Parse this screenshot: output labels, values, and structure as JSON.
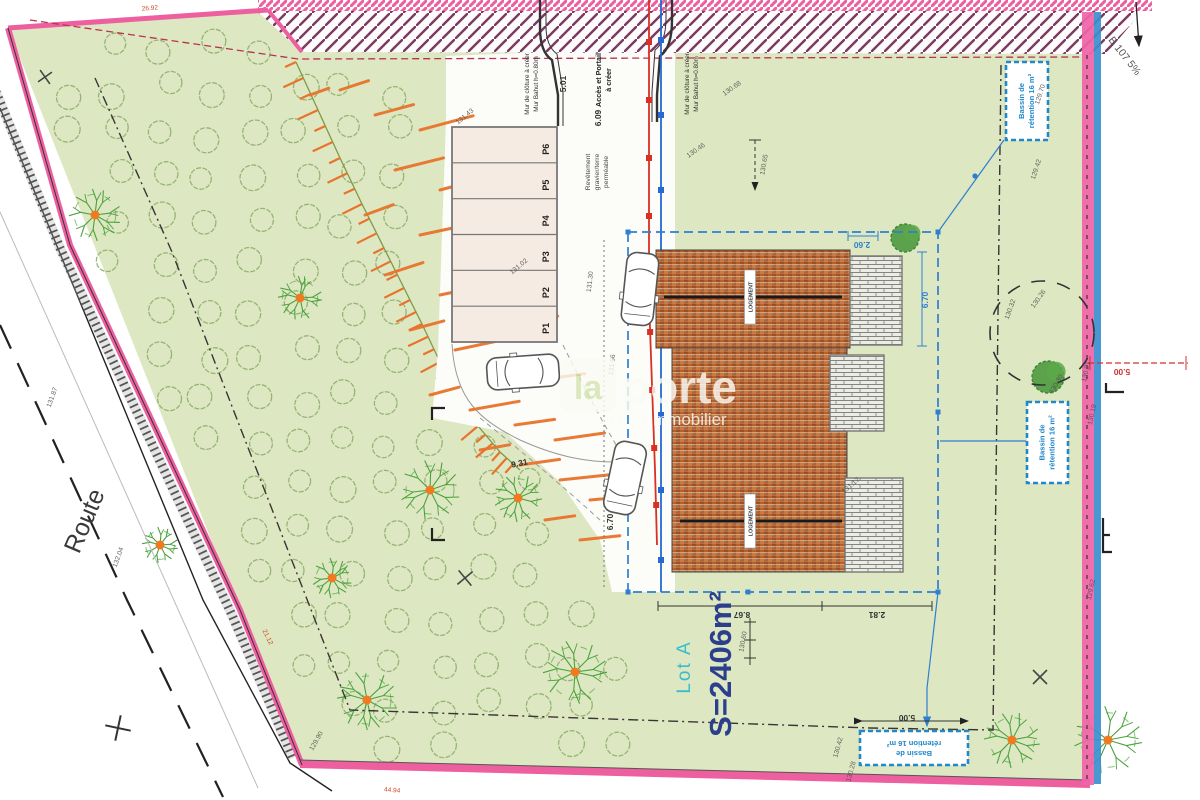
{
  "watermark": {
    "logo_text": "la",
    "brand": "porte",
    "tagline": "le sens de l'immobilier"
  },
  "site": {
    "road_label": "Route",
    "lot_label": "Lot A",
    "lot_area": "S=2406m²",
    "adjacent_label": "B 107 5%",
    "access_line1": "Accès et Portail",
    "access_line2": "à créer",
    "wall_label_line1": "Mur de clôture à créer",
    "wall_label_line2": "Mur Bahut h=0.80m",
    "surface_label": [
      "Revêtement",
      "gravier/terre",
      "perméable"
    ],
    "basin_line1": "Bassin de",
    "basin_line2": "rétention 16 m²",
    "ridge_label": "LOGEMENT"
  },
  "parking": {
    "spaces": [
      "P1",
      "P2",
      "P3",
      "P4",
      "P5",
      "P6"
    ]
  },
  "dimensions": [
    {
      "t": "5.01",
      "x": 566,
      "y": 84,
      "r": -90,
      "c": "dark"
    },
    {
      "t": "6.09",
      "x": 601,
      "y": 118,
      "r": -90,
      "c": "dark"
    },
    {
      "t": "2.60",
      "x": 862,
      "y": 242,
      "r": 180,
      "c": "blue"
    },
    {
      "t": "6.70",
      "x": 928,
      "y": 300,
      "r": -90,
      "c": "blue"
    },
    {
      "t": "6.70",
      "x": 613,
      "y": 522,
      "r": -90,
      "c": "dark"
    },
    {
      "t": "9.31",
      "x": 520,
      "y": 466,
      "r": -12,
      "c": "dark"
    },
    {
      "t": "8.67",
      "x": 742,
      "y": 612,
      "r": 180,
      "c": "dark"
    },
    {
      "t": "2.81",
      "x": 877,
      "y": 612,
      "r": 180,
      "c": "dark"
    },
    {
      "t": "5.00",
      "x": 907,
      "y": 715,
      "r": 180,
      "c": "dark"
    },
    {
      "t": "5.00",
      "x": 1122,
      "y": 369,
      "r": 180,
      "c": "red"
    }
  ],
  "elevations": [
    {
      "t": "130.68",
      "x": 733,
      "y": 90,
      "r": -35
    },
    {
      "t": "130.46",
      "x": 697,
      "y": 152,
      "r": -35
    },
    {
      "t": "130.65",
      "x": 766,
      "y": 165,
      "r": -80
    },
    {
      "t": "129.70",
      "x": 1042,
      "y": 95,
      "r": -72
    },
    {
      "t": "129.42",
      "x": 1038,
      "y": 170,
      "r": -72
    },
    {
      "t": "130.32",
      "x": 1012,
      "y": 310,
      "r": -70
    },
    {
      "t": "130.26",
      "x": 1040,
      "y": 300,
      "r": -55
    },
    {
      "t": "130.30",
      "x": 1058,
      "y": 385,
      "r": -60
    },
    {
      "t": "130.21",
      "x": 1088,
      "y": 372,
      "r": -78
    },
    {
      "t": "130.19",
      "x": 1094,
      "y": 415,
      "r": -78
    },
    {
      "t": "129.62",
      "x": 1093,
      "y": 590,
      "r": -78
    },
    {
      "t": "130.42",
      "x": 840,
      "y": 748,
      "r": -75
    },
    {
      "t": "130.28",
      "x": 853,
      "y": 772,
      "r": -75
    },
    {
      "t": "131.17",
      "x": 852,
      "y": 487,
      "r": -40
    },
    {
      "t": "131.43",
      "x": 466,
      "y": 118,
      "r": -40
    },
    {
      "t": "131.02",
      "x": 520,
      "y": 268,
      "r": -40
    },
    {
      "t": "131.30",
      "x": 592,
      "y": 282,
      "r": -83
    },
    {
      "t": "131.66",
      "x": 614,
      "y": 365,
      "r": -83
    },
    {
      "t": "132.04",
      "x": 120,
      "y": 558,
      "r": -70
    },
    {
      "t": "131.87",
      "x": 54,
      "y": 398,
      "r": -70
    },
    {
      "t": "129.90",
      "x": 318,
      "y": 742,
      "r": -60
    },
    {
      "t": "130.60",
      "x": 745,
      "y": 642,
      "r": -80
    }
  ],
  "boundary_lengths": [
    {
      "t": "21.12",
      "x": 266,
      "y": 638,
      "r": 64
    },
    {
      "t": "44.94",
      "x": 392,
      "y": 792,
      "r": 5
    },
    {
      "t": "26.92",
      "x": 150,
      "y": 10,
      "r": -4
    }
  ],
  "colors": {
    "lot_green": "#dde8c2",
    "boundary_pink": "#ee5fa0",
    "hatch_purple": "#7a3a5e",
    "talus_orange": "#e8742c",
    "tree_green": "#4aa23c",
    "circle_green": "#8fae6d",
    "utility_red": "#d93025",
    "utility_blue": "#2469d4",
    "envelope_blue": "#2e7fd0",
    "basin_blue": "#2288c8",
    "roof_orange": "#b4612e",
    "terrace_gray": "#85857d",
    "lot_text_cyan": "#3bbccc",
    "area_text_blue": "#2b3f8c",
    "dim_red": "#d03030"
  }
}
